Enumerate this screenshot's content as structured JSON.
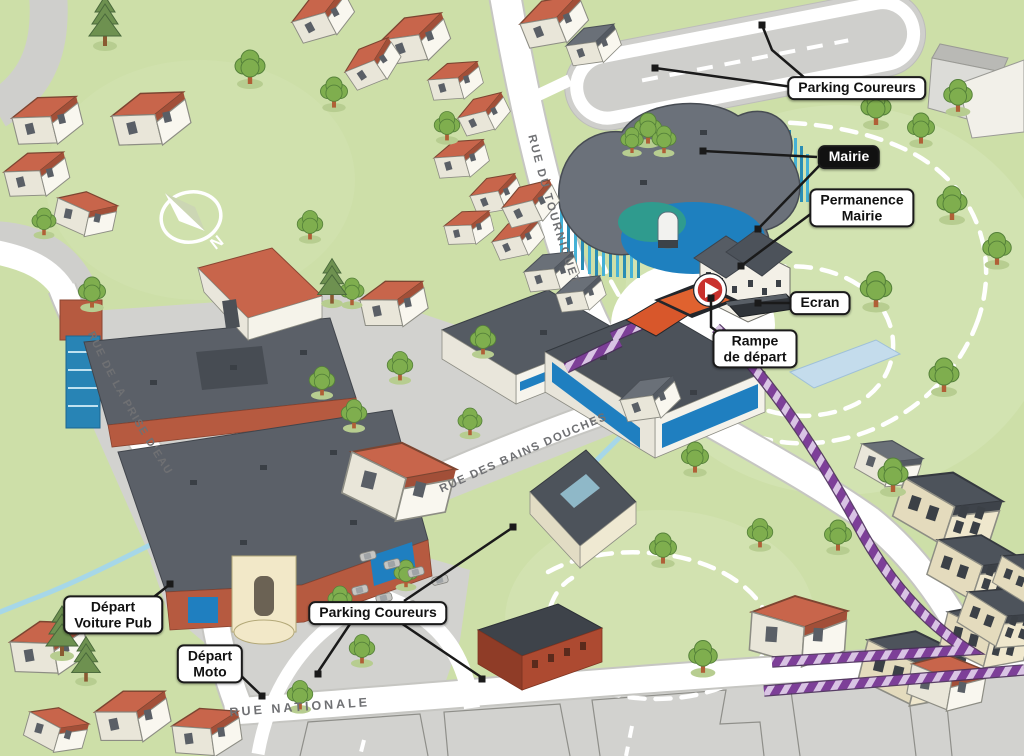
{
  "map": {
    "callouts": {
      "parking_coureurs_top": {
        "label": "Parking Coureurs"
      },
      "mairie": {
        "label": "Mairie"
      },
      "permanence_mairie": {
        "line1": "Permanence",
        "line2": "Mairie"
      },
      "ecran": {
        "label": "Ecran"
      },
      "rampe_de_depart": {
        "line1": "Rampe",
        "line2": "de départ"
      },
      "depart_voiture_pub": {
        "line1": "Départ",
        "line2": "Voiture Pub"
      },
      "depart_moto": {
        "line1": "Départ",
        "line2": "Moto"
      },
      "parking_coureurs_bottom": {
        "label": "Parking Coureurs"
      }
    },
    "streets": {
      "rue_du_tourniquet": "RUE DU TOURNIQUET",
      "rue_des_bains_douches": "RUE DES BAINS DOUCHES",
      "rue_nationale": "RUE NATIONALE",
      "rue_de_la_prise_deau": "RUE DE LA PRISE D'EAU"
    },
    "compass": {
      "north": "N"
    },
    "icons": {
      "compass": "compass-icon",
      "play": "play-icon"
    },
    "colors": {
      "grass": "#cddfa8",
      "park_green": "#d7e5b8",
      "road_white": "#ffffff",
      "road_casing": "#c6c6c2",
      "asphalt": "#d2d2cf",
      "roof_red": "#c8654b",
      "roof_dark": "#565c64",
      "wall_white": "#f8f6ee",
      "wall_cream": "#efe7cd",
      "accent_blue": "#1f7fc0",
      "slat_blue": "#45b1d6",
      "pond_blue": "#1e80bf",
      "route_purple": "#7d3f98",
      "route_light": "#d9c4e4",
      "leader_black": "#1a1a1a",
      "tree_green": "#7fae4e",
      "pine_green": "#6e9150",
      "stream_blue": "#a6d7e8",
      "street_text": "#6f7073",
      "label_bg": "#ffffff",
      "label_text": "#111111",
      "mairie_label_bg": "#111111",
      "mairie_label_text": "#ffffff",
      "play_red": "#c9322e"
    }
  }
}
